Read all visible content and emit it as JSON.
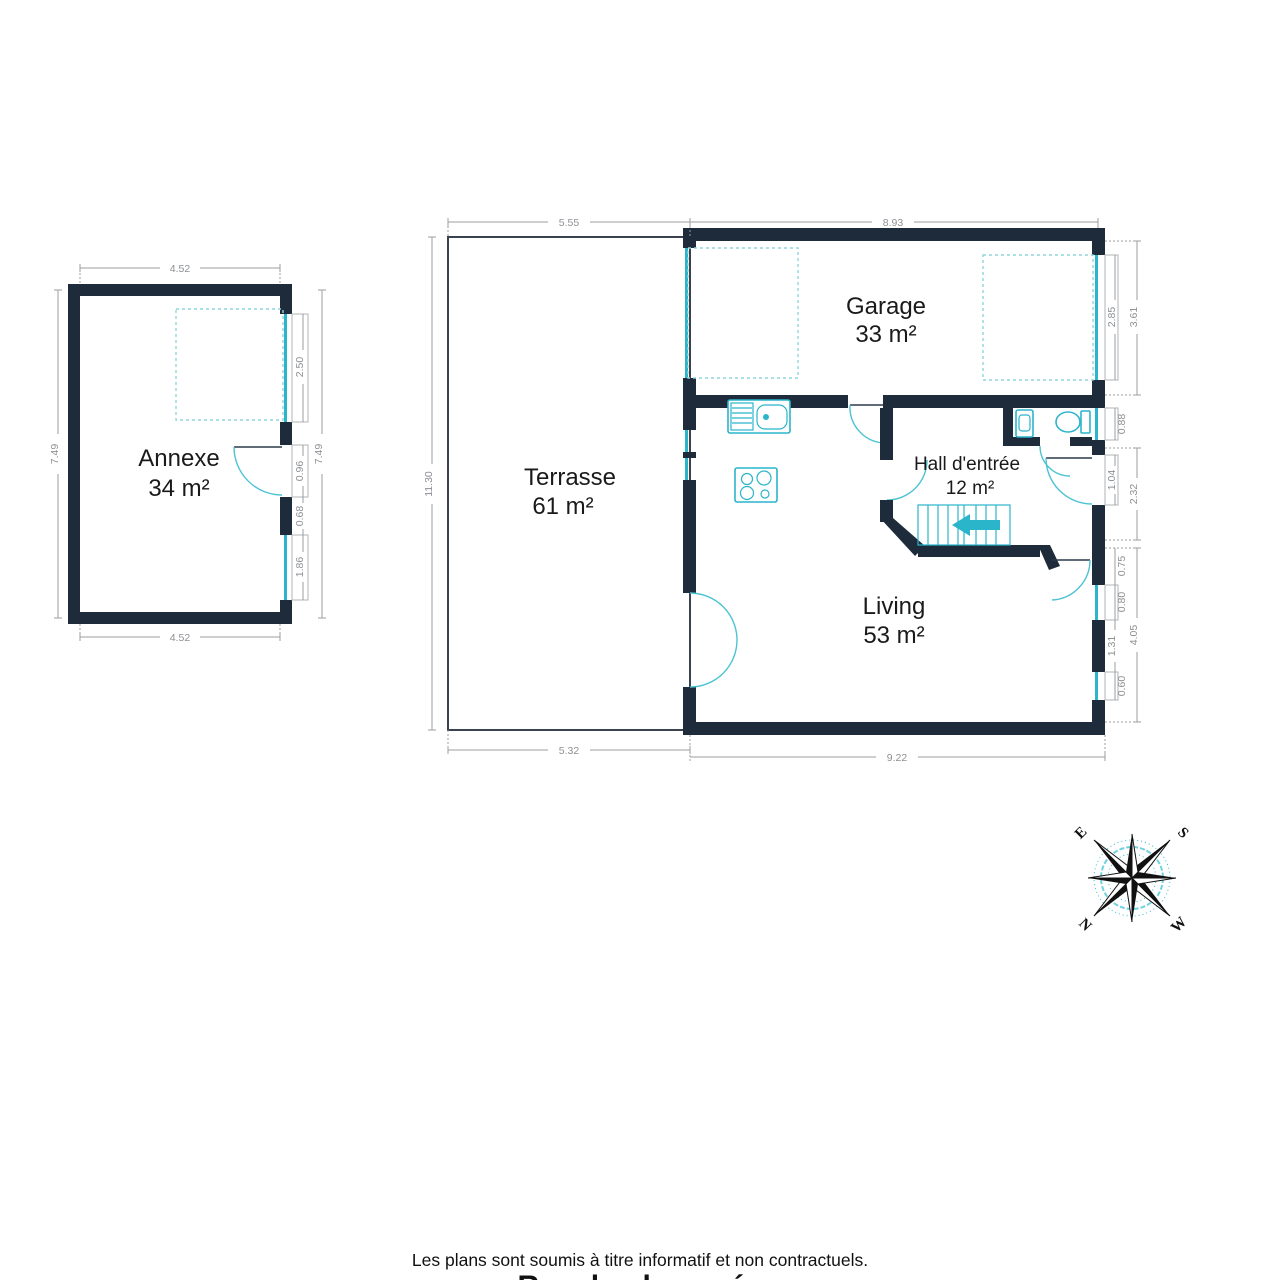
{
  "page": {
    "disclaimer": "Les plans sont soumis à titre informatif et non contractuels.",
    "title": "Rez-de-chaussée"
  },
  "rooms": {
    "annexe": {
      "name": "Annexe",
      "area": "34 m²"
    },
    "terrasse": {
      "name": "Terrasse",
      "area": "61 m²"
    },
    "garage": {
      "name": "Garage",
      "area": "33 m²"
    },
    "hall": {
      "name": "Hall d'entrée",
      "area": "12 m²"
    },
    "living": {
      "name": "Living",
      "area": "53 m²"
    }
  },
  "dims": {
    "annexe": {
      "top": "4.52",
      "bottom": "4.52",
      "left": "7.49",
      "right": "7.49",
      "window_top": "2.50",
      "door": "0.96",
      "pier": "0.68",
      "window_bottom": "1.86"
    },
    "main": {
      "top_terrasse": "5.55",
      "top_garage": "8.93",
      "left": "11.30",
      "bottom_terrasse": "5.32",
      "bottom_living": "9.22",
      "garage_door": "2.85",
      "garage_wall": "3.61",
      "wc_window": "0.88",
      "entry_door": "1.04",
      "entry_wall": "2.32",
      "pier_a": "0.75",
      "window_a": "0.80",
      "pier_b": "1.31",
      "window_b": "0.60",
      "living_wall": "4.05"
    }
  },
  "compass": {
    "e": "E",
    "s": "S",
    "w": "W",
    "n": "N"
  },
  "colors": {
    "wall": "#1d2b3a",
    "fixture": "#2ab5cb",
    "dimension": "#9b9b9b",
    "text": "#1a1a1a"
  }
}
